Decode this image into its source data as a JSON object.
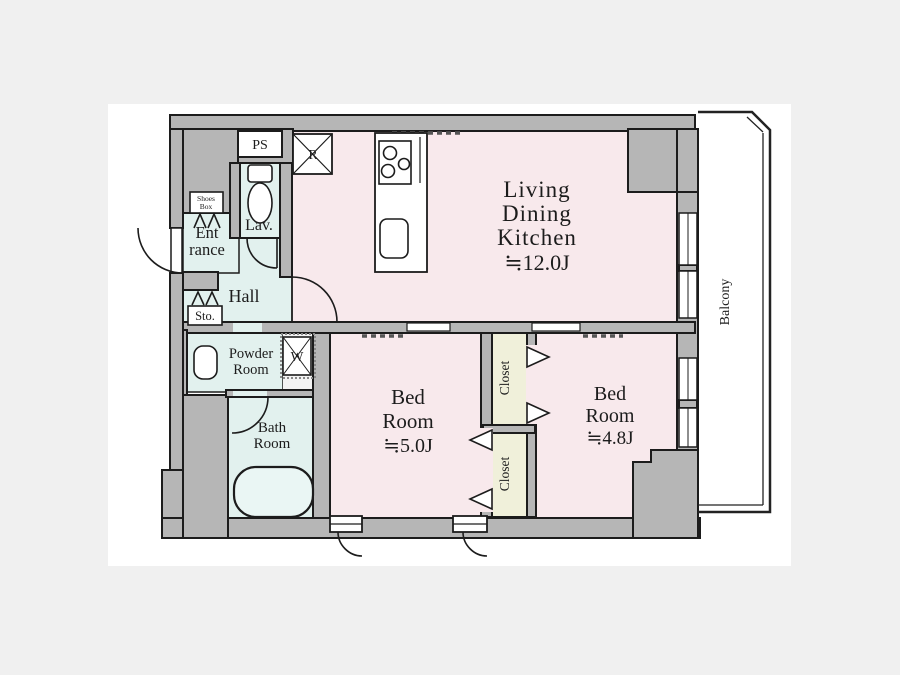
{
  "colors": {
    "page_background": "#f0f0f0",
    "paper": "#ffffff",
    "wall_gray": "#b6b6b6",
    "line_black": "#1c1c1c",
    "room_pink": "#f8e9ec",
    "room_cyan": "#e2f1ee",
    "closet_cream": "#f0f0da"
  },
  "labels": {
    "ldk": {
      "line1": "Living",
      "line2": "Dining",
      "line3": "Kitchen",
      "size": "≒12.0J"
    },
    "bedroom_5": {
      "line1": "Bed",
      "line2": "Room",
      "size": "≒5.0J"
    },
    "bedroom_48": {
      "line1": "Bed",
      "line2": "Room",
      "size": "≒4.8J"
    },
    "closet_upper": "Closet",
    "closet_lower": "Closet",
    "balcony": "Balcony",
    "hall": "Hall",
    "lavatory": "Lav.",
    "powder_room": {
      "line1": "Powder",
      "line2": "Room"
    },
    "bath_room": {
      "line1": "Bath",
      "line2": "Room"
    },
    "entrance": {
      "line1": "Ent",
      "line2": "rance"
    },
    "storage": "Sto.",
    "shoes_box": {
      "line1": "Shoes",
      "line2": "Box"
    },
    "pipe_space": "PS",
    "refrigerator": "R",
    "washing_machine": "W"
  }
}
